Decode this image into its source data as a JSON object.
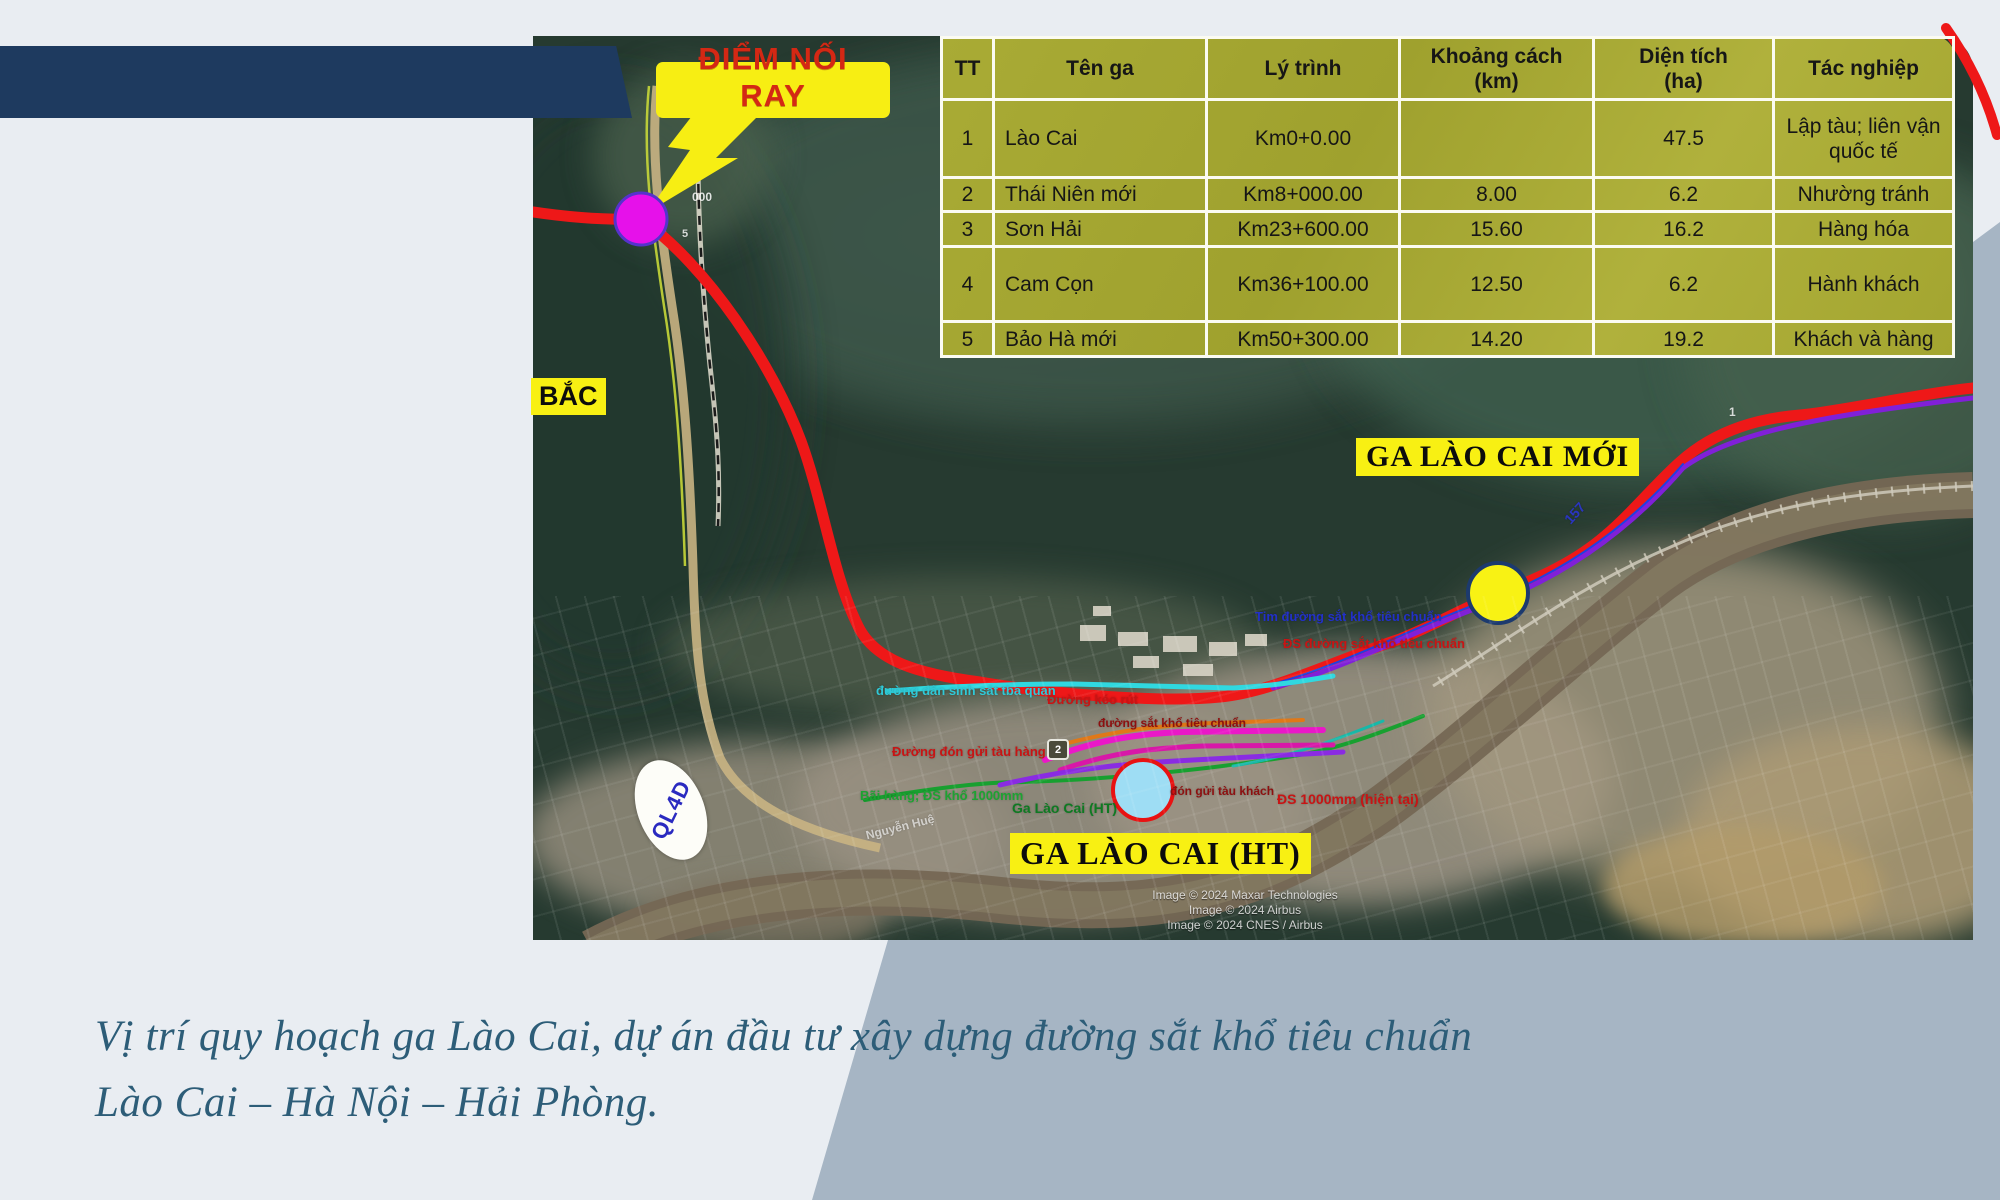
{
  "page": {
    "colors": {
      "background": "#e9edf2",
      "accent_panel": "#a6b5c4",
      "topbar": "#1e3a5f",
      "callout_yellow": "#f7ee13",
      "callout_text": "#d42814",
      "table_olive": "#a6a832",
      "red_route": "#ee1818",
      "caption_text": "#2d5d78"
    }
  },
  "caption": {
    "line1": "Vị trí quy hoạch ga Lào Cai, dự án đầu tư xây dựng đường sắt khổ tiêu chuẩn",
    "line2": "Lào Cai – Hà Nội – Hải Phòng."
  },
  "map": {
    "callout": {
      "line1": "ĐIỂM NỐI",
      "line2": "RAY"
    },
    "labels": {
      "north": "BẮC",
      "road_shield": "QL4D",
      "shield2": "2",
      "new_station": "GA LÀO CAI MỚI",
      "existing_station": "GA LÀO CAI (HT)"
    },
    "annotations": [
      {
        "text": "đường dân sinh sát tba quan",
        "color": "#2fc9d8",
        "x": 876,
        "y": 683,
        "size": 13,
        "rot": 0
      },
      {
        "text": "Đường kéo rút",
        "color": "#c81414",
        "x": 1047,
        "y": 692,
        "size": 13,
        "rot": 0
      },
      {
        "text": "đường sắt khổ tiêu chuẩn",
        "color": "#8d1010",
        "x": 1098,
        "y": 716,
        "size": 12,
        "rot": 0
      },
      {
        "text": "Đường đón gửi tàu hàng",
        "color": "#c81414",
        "x": 892,
        "y": 744,
        "size": 13,
        "rot": 0
      },
      {
        "text": "Bãi hàng; ĐS khổ 1000mm",
        "color": "#1da332",
        "x": 860,
        "y": 788,
        "size": 13,
        "rot": 0
      },
      {
        "text": "Ga Lào Cai (HT)",
        "color": "#0e7a22",
        "x": 1012,
        "y": 800,
        "size": 14,
        "rot": 0
      },
      {
        "text": "đón gửi tàu khách",
        "color": "#8d1010",
        "x": 1170,
        "y": 784,
        "size": 12,
        "rot": 0
      },
      {
        "text": "ĐS 1000mm (hiện tại)",
        "color": "#c81414",
        "x": 1277,
        "y": 791,
        "size": 14,
        "rot": 0
      },
      {
        "text": "Tim đường sắt khổ tiêu chuẩn",
        "color": "#2230c8",
        "x": 1255,
        "y": 609,
        "size": 13,
        "rot": 0
      },
      {
        "text": "ĐS đường sắt khổ tiêu chuẩn",
        "color": "#c81414",
        "x": 1283,
        "y": 636,
        "size": 13,
        "rot": 0
      },
      {
        "text": "157",
        "color": "#2a35c0",
        "x": 1563,
        "y": 505,
        "size": 14,
        "rot": -48
      },
      {
        "text": "Nguyễn Huệ",
        "color": "rgba(255,255,255,0.65)",
        "x": 865,
        "y": 820,
        "size": 12,
        "rot": -14
      },
      {
        "text": "000",
        "color": "rgba(255,255,255,0.85)",
        "x": 692,
        "y": 190,
        "size": 12,
        "rot": 0
      },
      {
        "text": "5",
        "color": "rgba(255,255,255,0.8)",
        "x": 682,
        "y": 228,
        "size": 11,
        "rot": 0
      },
      {
        "text": "1",
        "color": "rgba(255,255,255,0.8)",
        "x": 1729,
        "y": 405,
        "size": 12,
        "rot": 0
      }
    ],
    "attribution": [
      "Image © 2024 Maxar Technologies",
      "Image © 2024 Airbus",
      "Image © 2024 CNES / Airbus"
    ]
  },
  "table": {
    "headers": [
      "TT",
      "Tên ga",
      "Lý trình",
      "Khoảng cách\n(km)",
      "Diện tích\n(ha)",
      "Tác nghiệp"
    ],
    "rows": [
      [
        "1",
        "Lào Cai",
        "Km0+0.00",
        "",
        "47.5",
        "Lập tàu; liên vận quốc tế"
      ],
      [
        "2",
        "Thái Niên mới",
        "Km8+000.00",
        "8.00",
        "6.2",
        "Nhường tránh"
      ],
      [
        "3",
        "Sơn Hải",
        "Km23+600.00",
        "15.60",
        "16.2",
        "Hàng hóa"
      ],
      [
        "4",
        "Cam Cọn",
        "Km36+100.00",
        "12.50",
        "6.2",
        "Hành khách"
      ],
      [
        "5",
        "Bảo Hà mới",
        "Km50+300.00",
        "14.20",
        "19.2",
        "Khách và hàng"
      ]
    ]
  }
}
